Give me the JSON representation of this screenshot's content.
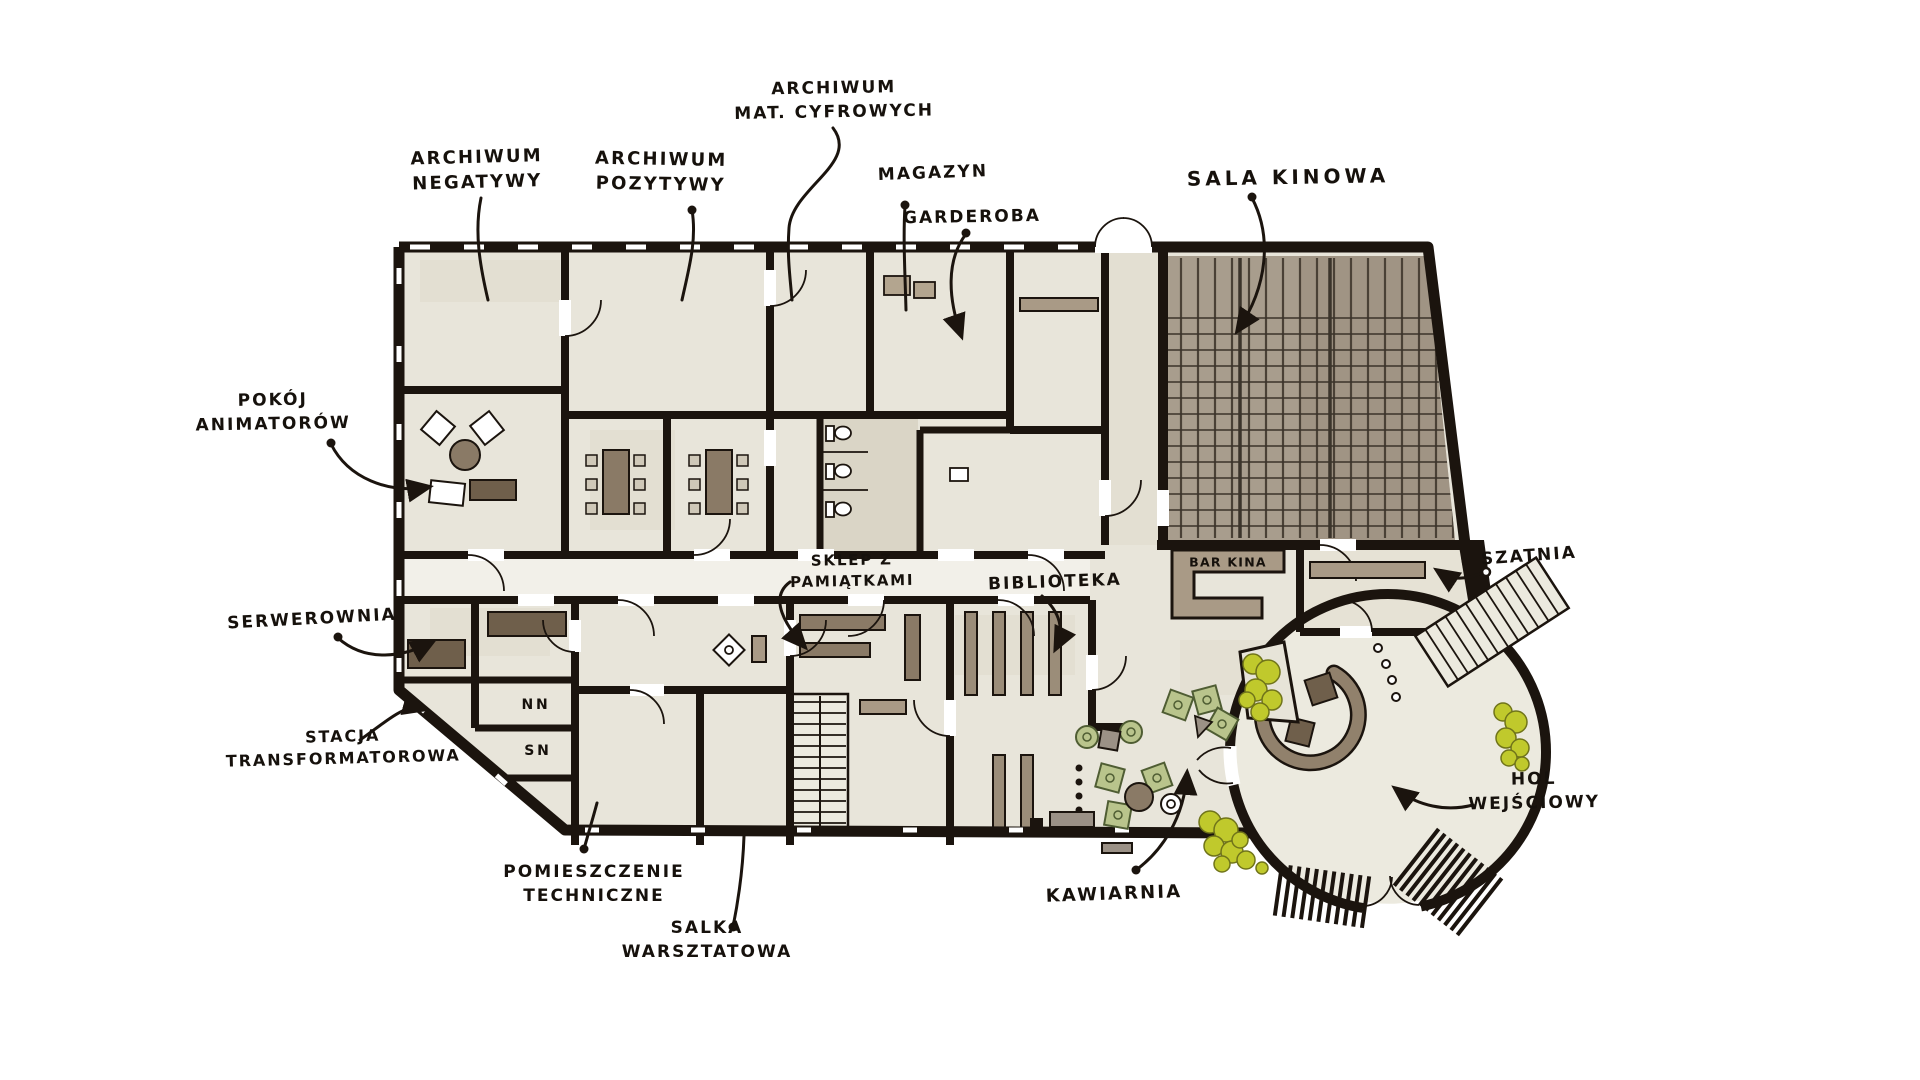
{
  "labels": {
    "archiwum_negatywy": {
      "text": "ARCHIWUM\nNEGATYWY"
    },
    "archiwum_pozytywy": {
      "text": "ARCHIWUM\nPOZYTYWY"
    },
    "archiwum_mat_cyfrowych": {
      "text": "ARCHIWUM\nMAT. CYFROWYCH"
    },
    "magazyn": {
      "text": "MAGAZYN"
    },
    "garderoba": {
      "text": "GARDEROBA"
    },
    "sala_kinowa": {
      "text": "SALA KINOWA"
    },
    "pokoj_animatorow": {
      "text": "POKÓJ\nANIMATORÓW"
    },
    "serwerownia": {
      "text": "SERWEROWNIA"
    },
    "stacja_transformatorowa": {
      "text": "STACJA\nTRANSFORMATOROWA"
    },
    "nn": {
      "text": "NN"
    },
    "sn": {
      "text": "SN"
    },
    "sklep_z_pamiatkami": {
      "text": "SKLEP Z\nPAMIĄTKAMI"
    },
    "biblioteka": {
      "text": "BIBLIOTEKA"
    },
    "bar_kina": {
      "text": "BAR KINA"
    },
    "szatnia": {
      "text": "SZATNIA"
    },
    "hol_wejsciowy": {
      "text": "HOL\nWEJŚCIOWY"
    },
    "kawiarnia": {
      "text": "KAWIARNIA"
    },
    "pomieszczenie_techniczne": {
      "text": "POMIESZCZENIE\nTECHNICZNE"
    },
    "salka_warsztatowa": {
      "text": "SALKA\nWARSZTATOWA"
    }
  },
  "colors": {
    "ink": "#1b140e",
    "paper": "#ffffff",
    "floor": "#e8e5da",
    "corridor": "#f2f0e9",
    "cinema_wash": "#a89d8d",
    "seat_column_line": "#4a4136",
    "seat_row_line": "#3a332a",
    "furniture_brown": "#8a7a66",
    "furniture_dark": "#6f5f4b",
    "taupe": "#a99a86",
    "gray": "#9b9186",
    "plant_green": "#c0c92c",
    "plant_outline": "#70741a",
    "chair_green": "#b9c48c",
    "chair_green_outline": "#4f5d33"
  }
}
